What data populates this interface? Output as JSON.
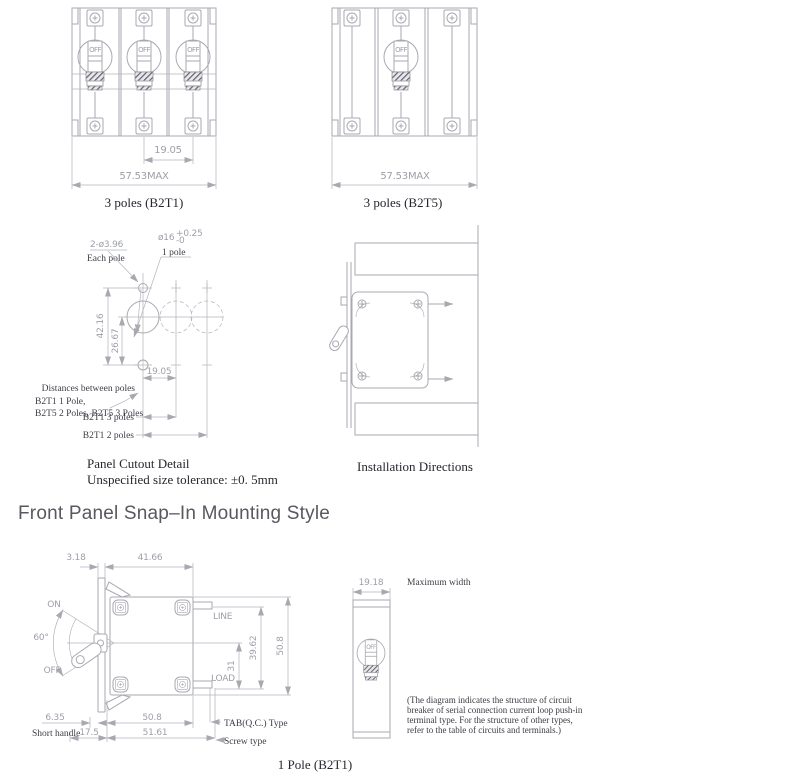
{
  "page": {
    "title": "Front Panel Snap–In Mounting Style"
  },
  "common": {
    "toggle_label": "OFF"
  },
  "colors": {
    "drawing_line": "#a8a9b0",
    "dimension_text": "#9da0a9",
    "label_text": "#3d3d46",
    "caption_text": "#26262e",
    "title_text": "#58585f",
    "hatch_band": "#61616a"
  },
  "b2t1_3pole": {
    "caption": "3 poles (B2T1)",
    "dim_pole_spacing": "19.05",
    "dim_max_width": "57.53MAX"
  },
  "b2t5_3pole": {
    "caption": "3 poles (B2T5)",
    "dim_max_width": "57.53MAX"
  },
  "panel_cutout": {
    "hole_dia": "2-ø3.96",
    "hole_dia_note": "Each pole",
    "bore_dia": "ø16",
    "bore_tol_plus": "+0.25",
    "bore_tol_minus": "-0",
    "bore_note": "1 pole",
    "dim_height": "42.16",
    "dim_center": "26.67",
    "dim_spacing": "19.05",
    "distances_label": "Distances between poles",
    "models_line1": "B2T1 1 Pole,",
    "models_line2": "B2T5 2 Poles, B2T5 3 Poles",
    "label_3_poles": "B2T1 3 poles",
    "label_2_poles": "B2T1 2 poles",
    "caption": "Panel Cutout Detail",
    "tolerance_note": "Unspecified size tolerance: ±0. 5mm"
  },
  "installation": {
    "caption": "Installation Directions"
  },
  "b2t1_1pole": {
    "caption": "1 Pole (B2T1)",
    "dim_panel_thickness": "3.18",
    "dim_body_depth": "41.66",
    "label_on": "ON",
    "label_angle": "60°",
    "label_off": "OFF",
    "dim_handle": "6.35",
    "label_short_handle": "Short handle",
    "dim_17_5": "17.5",
    "dim_bottom_width": "50.8",
    "dim_51_61": "51.61",
    "label_line": "LINE",
    "label_load": "LOAD",
    "dim_31": "31",
    "dim_39_62": "39.62",
    "dim_height": "50.8",
    "label_tab_type": "TAB(Q.C.) Type",
    "label_screw_type": "Screw type"
  },
  "front_view": {
    "dim_width": "19.18",
    "label_max_width": "Maximum width",
    "note_line1": "(The diagram indicates the structure of circuit",
    "note_line2": "breaker of serial connection current loop push-in",
    "note_line3": "terminal type. For the structure of other types,",
    "note_line4": "refer to the table of circuits and terminals.)"
  }
}
